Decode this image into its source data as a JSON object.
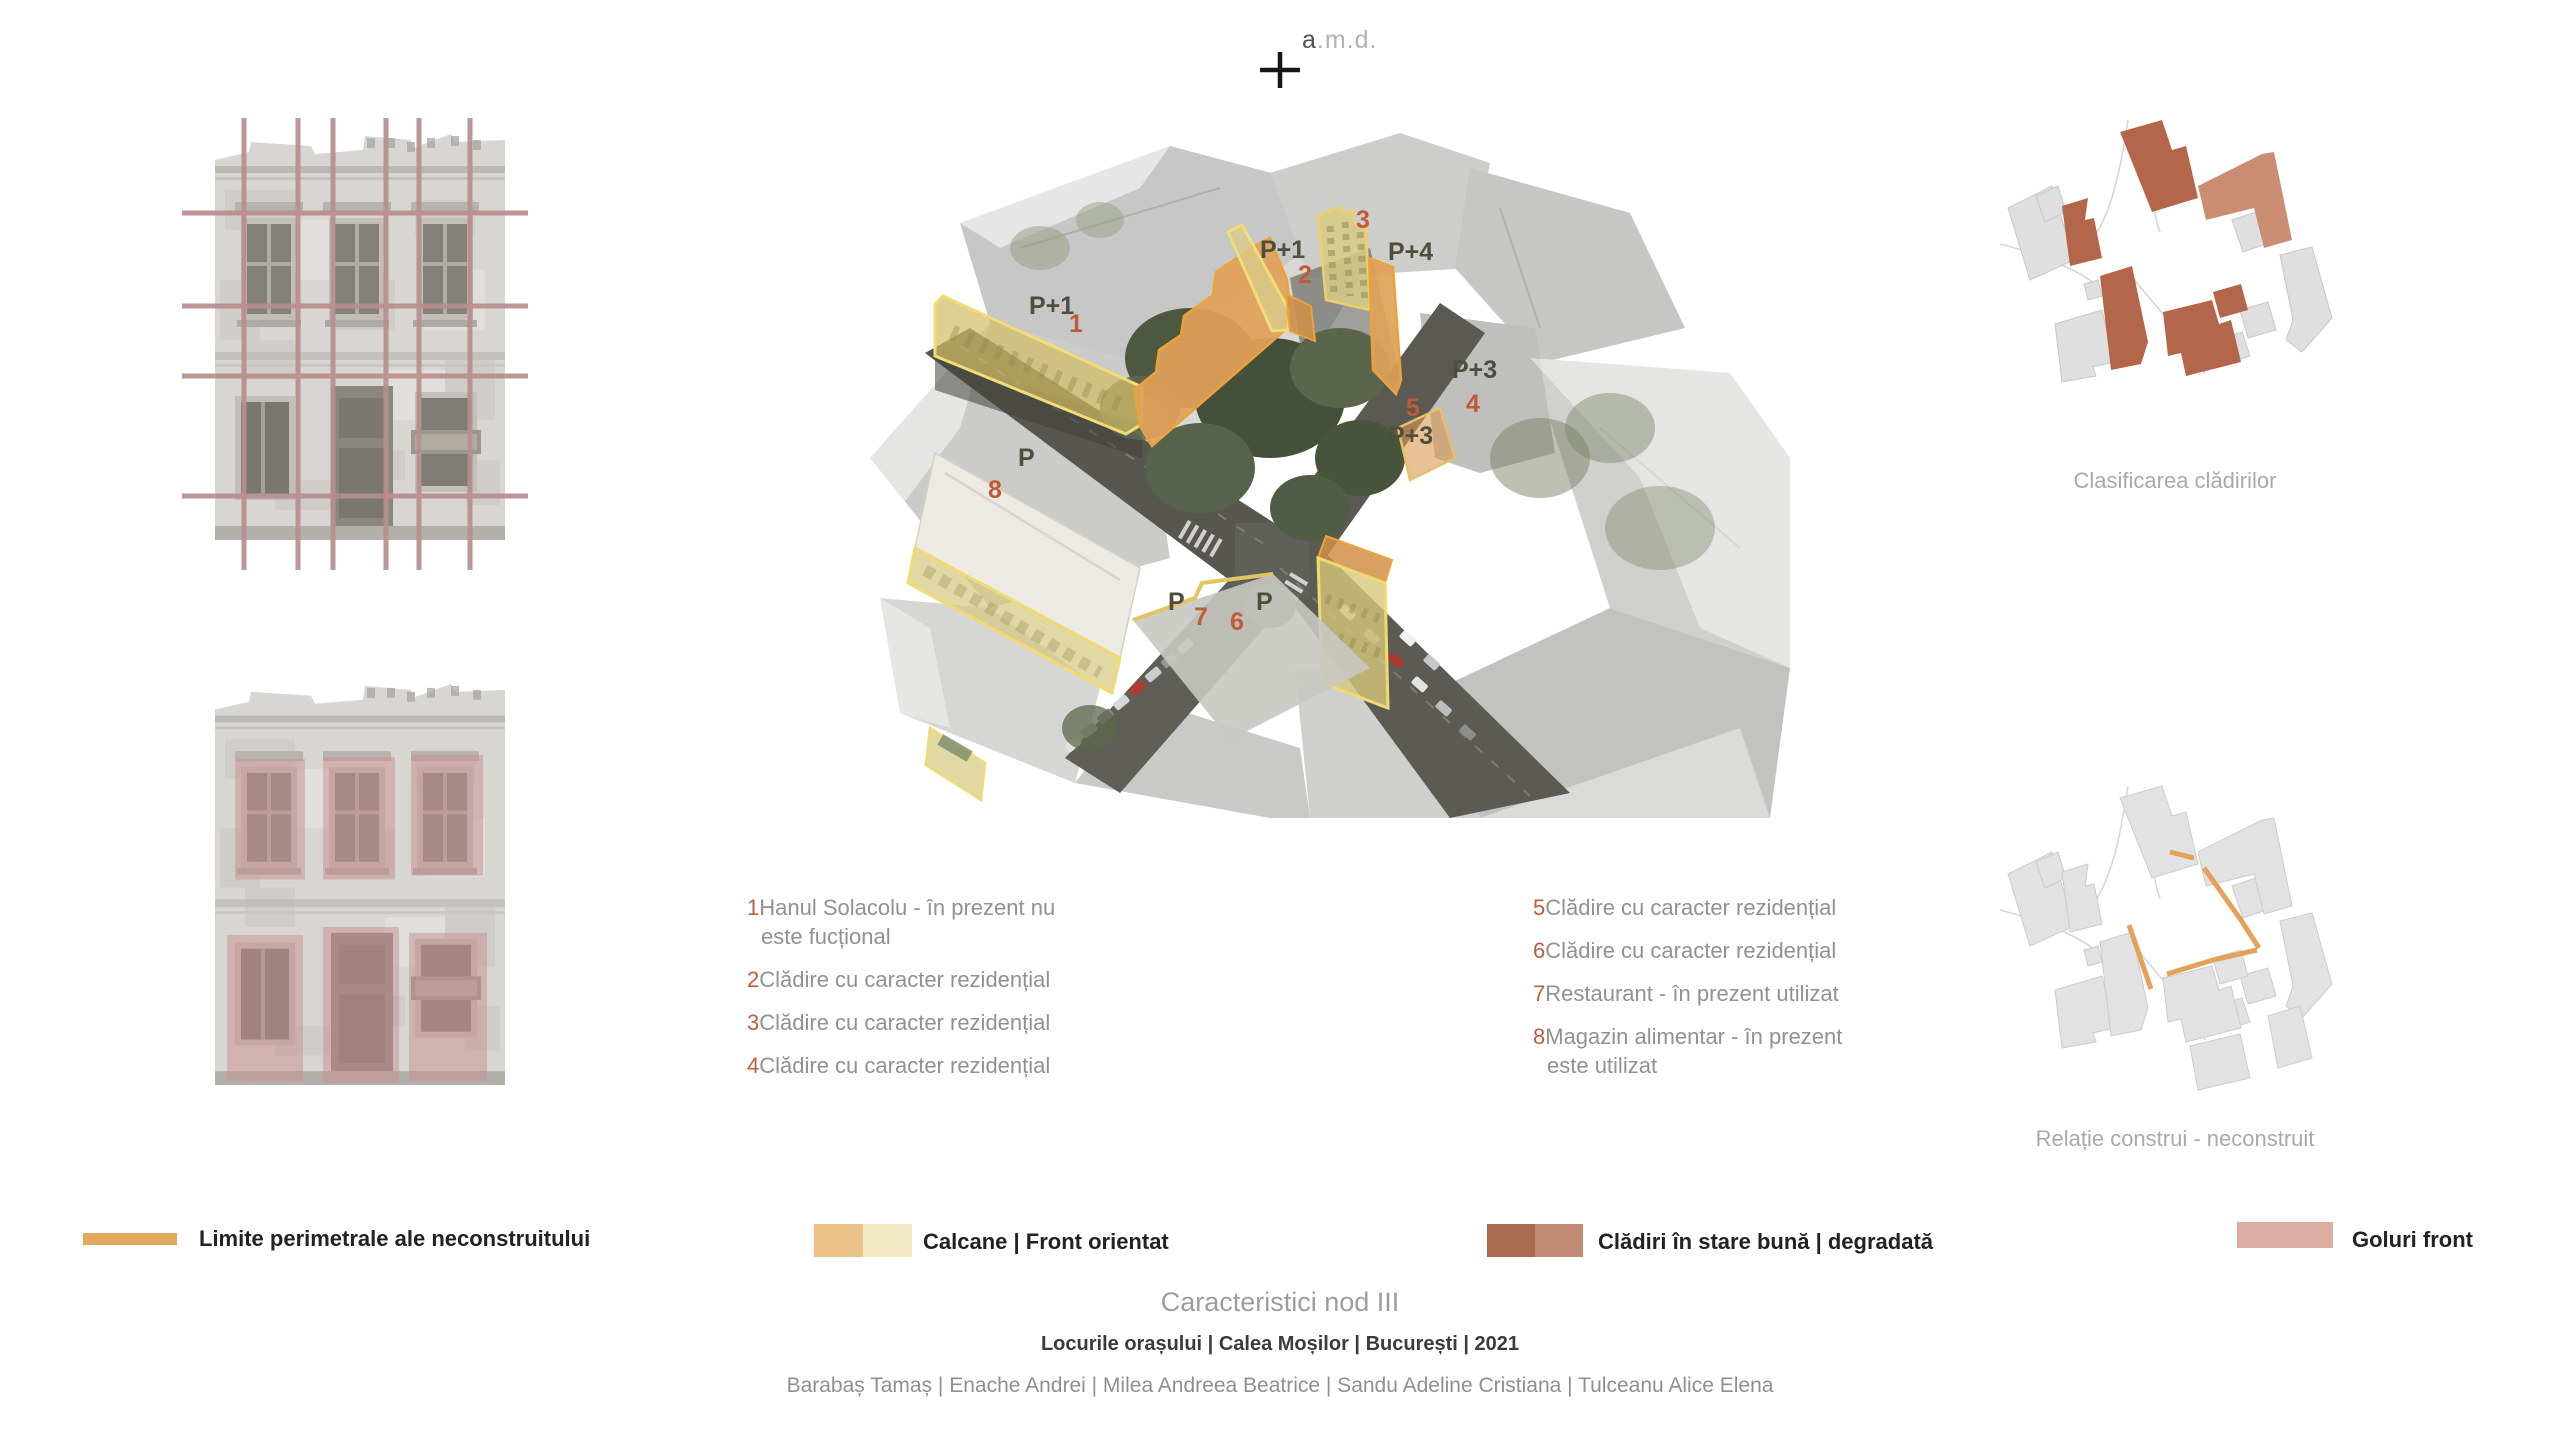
{
  "brand": {
    "dark": "a",
    "light": ".m.d."
  },
  "axon": {
    "labels": [
      "P+1",
      "1",
      "P+1",
      "2",
      "3",
      "P+4",
      "P+3",
      "4",
      "5",
      "P+3",
      "P",
      "8",
      "P",
      "7",
      "6",
      "P"
    ]
  },
  "right_panel": {
    "classification_caption": "Clasificarea clădirilor",
    "relation_caption": "Relație construi - neconstruit"
  },
  "building_list_left": [
    {
      "num": "1",
      "text": "Hanul Solacolu - în prezent nu este fucțional"
    },
    {
      "num": "2",
      "text": "Clădire cu caracter rezidențial"
    },
    {
      "num": "3",
      "text": "Clădire cu caracter rezidențial"
    },
    {
      "num": "4",
      "text": "Clădire cu caracter rezidențial"
    }
  ],
  "building_list_right": [
    {
      "num": "5",
      "text": "Clădire cu caracter rezidențial"
    },
    {
      "num": "6",
      "text": "Clădire cu caracter rezidențial"
    },
    {
      "num": "7",
      "text": "Restaurant - în prezent utilizat"
    },
    {
      "num": "8",
      "text": "Magazin alimentar - în prezent este utilizat"
    }
  ],
  "swatch_legend": [
    {
      "label": "Limite perimetrale ale neconstruitului",
      "colors": [
        "#e2a860"
      ]
    },
    {
      "label": "Calcane | Front orientat",
      "colors": [
        "#ecc089",
        "#f2e9c4"
      ]
    },
    {
      "label": "Clădiri în stare bună | degradată",
      "colors": [
        "#aa6b50",
        "#c18b74"
      ]
    },
    {
      "label": "Goluri front",
      "colors": [
        "#dcaea1"
      ]
    }
  ],
  "footer": {
    "title": "Caracteristici nod III",
    "subtitle": "Locurile orașului | Calea Moșilor | București | 2021",
    "authors": "Barabaș Tamaș | Enache Andrei | Milea Andreea Beatrice | Sandu Adeline Cristiana | Tulceanu Alice Elena"
  },
  "colors": {
    "highlight_front_outline": "#f2dc74",
    "highlight_calcan": "#e2a159",
    "number_accent": "#bf5b38",
    "floor_label": "#4e4e3d",
    "grid_overlay": "#b98e8e",
    "openings_overlay": "#c98f8f",
    "plan_good": "#b3664a",
    "plan_degraded": "#cc8e73",
    "plan_frontage_line": "#e3a257"
  }
}
